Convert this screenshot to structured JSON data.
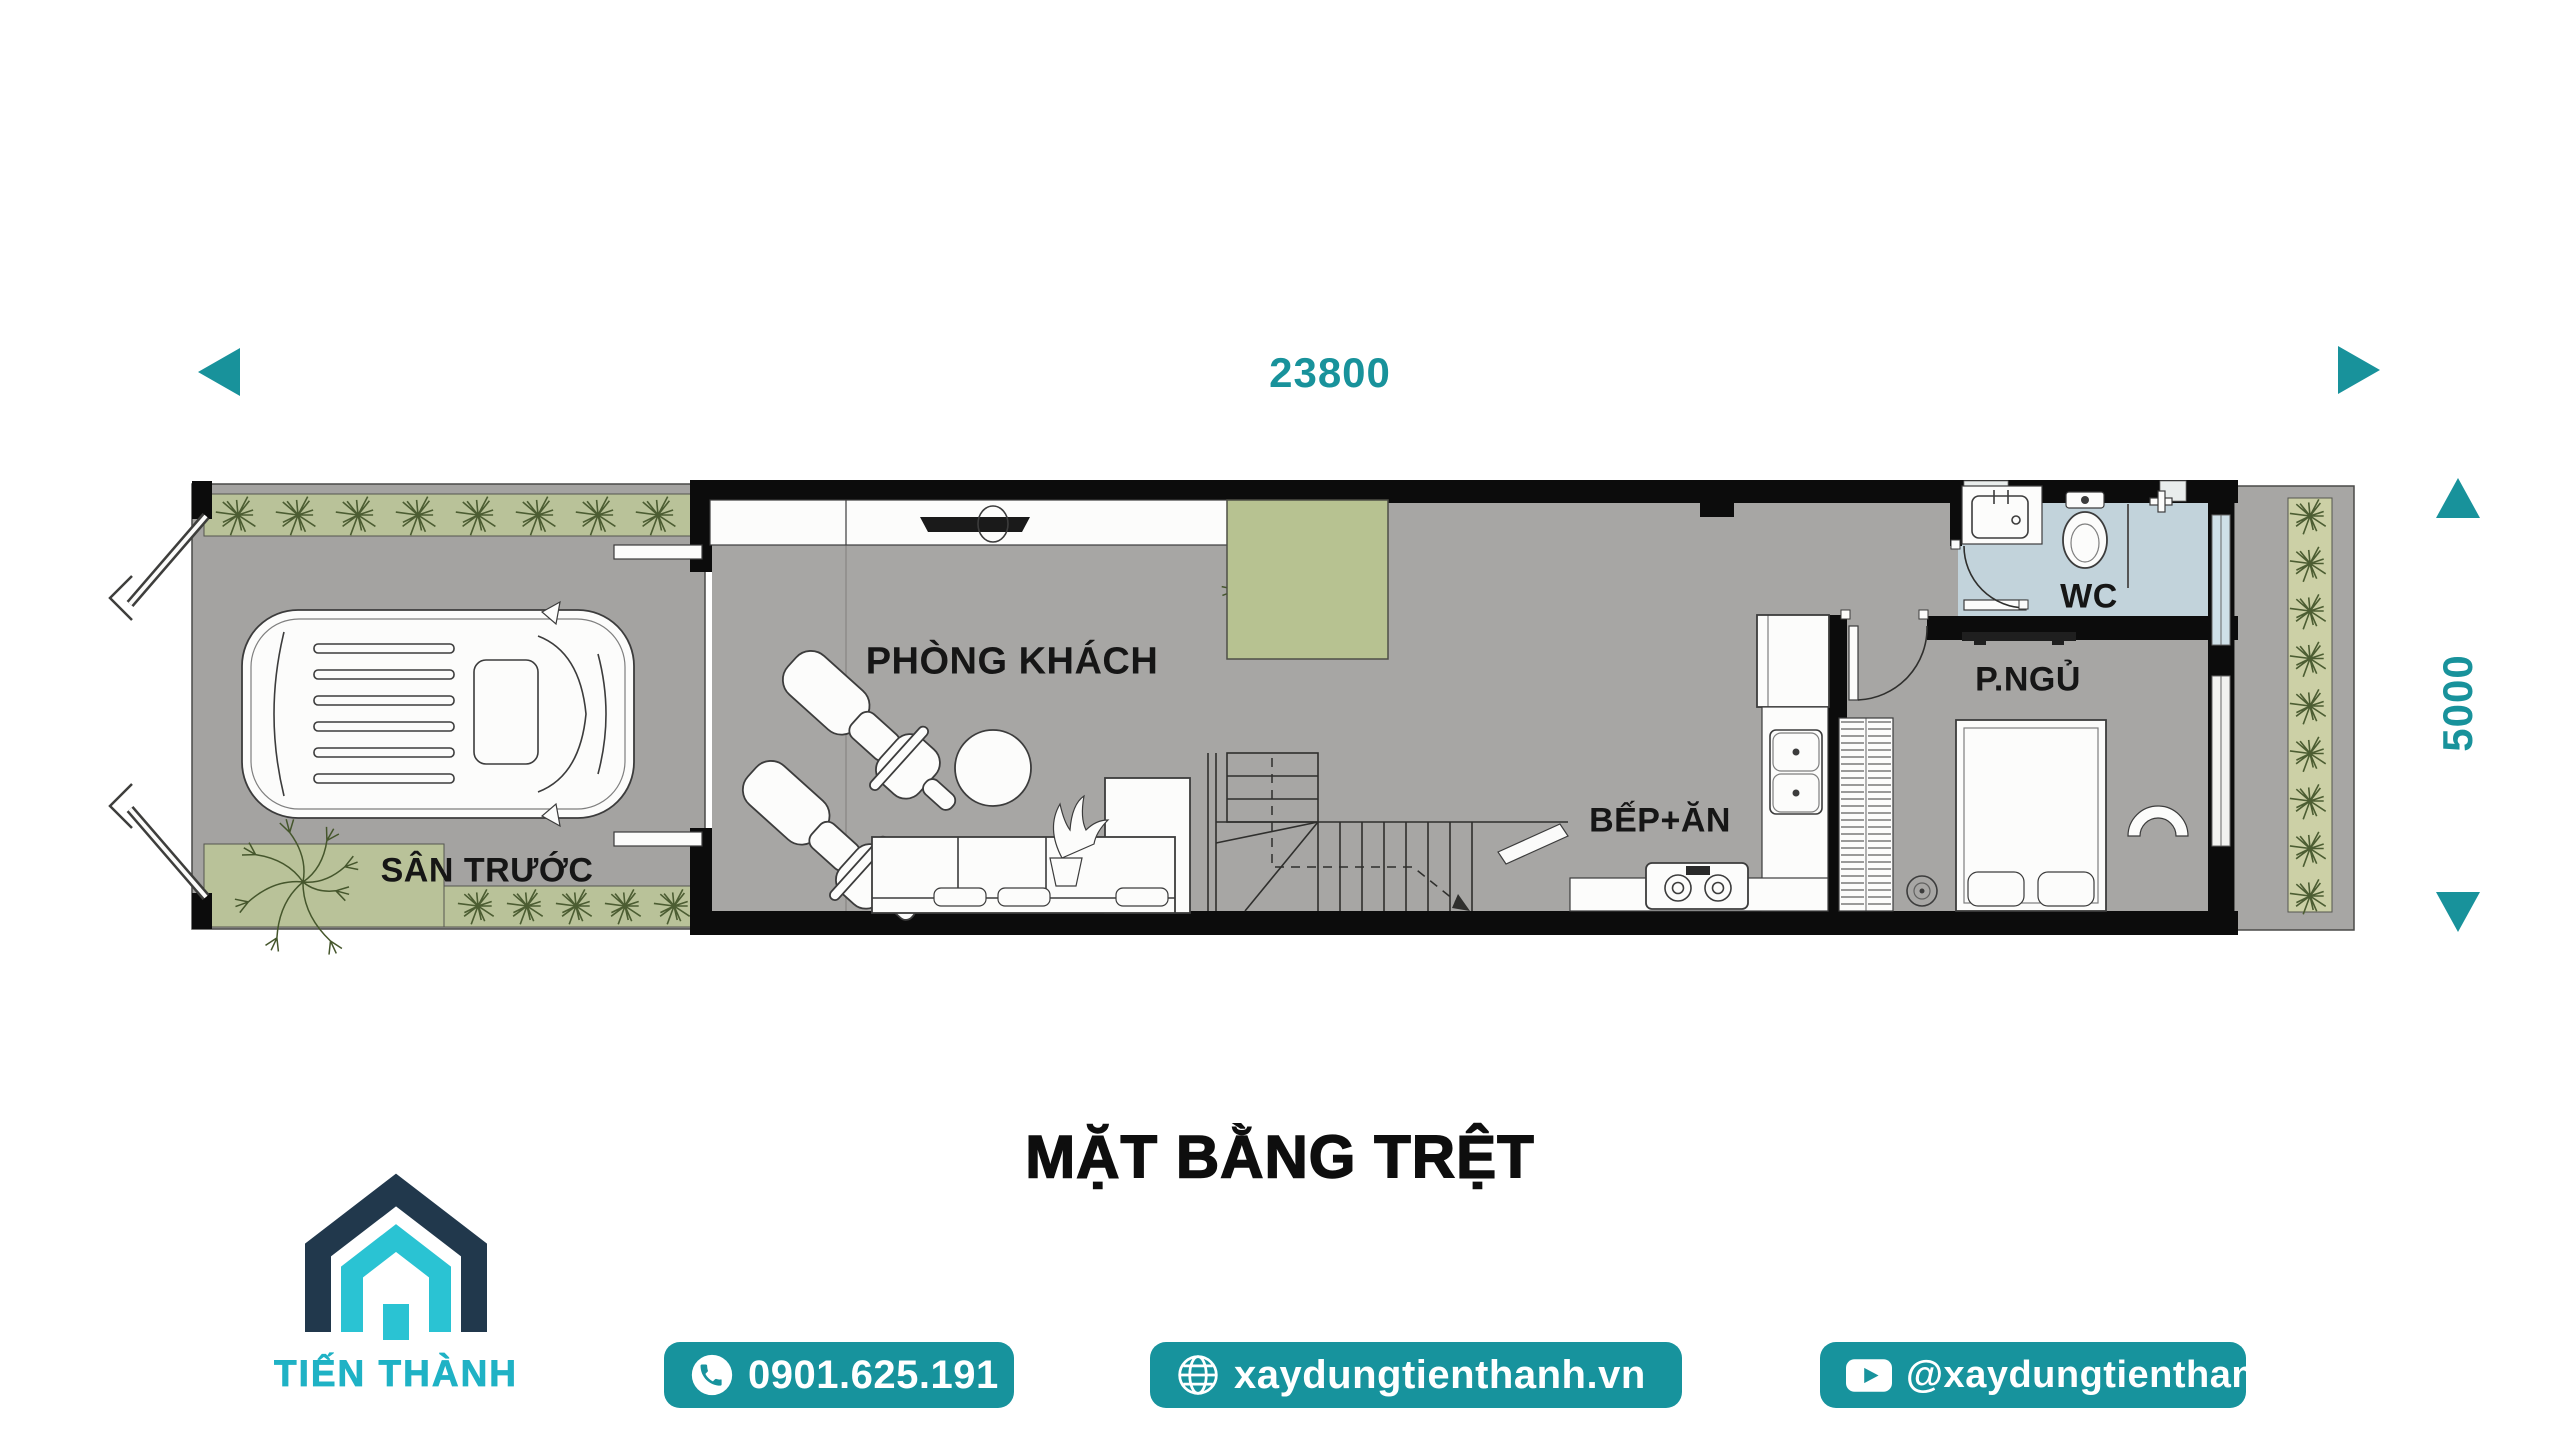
{
  "dimensions": {
    "width": {
      "label": "23800"
    },
    "depth": {
      "label": "5000"
    }
  },
  "plan": {
    "rooms": [
      {
        "id": "front-yard",
        "label": "SÂN TRƯỚC"
      },
      {
        "id": "living-room",
        "label": "PHÒNG KHÁCH"
      },
      {
        "id": "kitchen-dining",
        "label": "BẾP+ĂN"
      },
      {
        "id": "wc",
        "label": "WC"
      },
      {
        "id": "bedroom",
        "label": "P.NGỦ"
      }
    ]
  },
  "title": "MẶT BẰNG TRỆT",
  "footer": {
    "brand": "TIẾN THÀNH",
    "phone": "0901.625.191",
    "website": "xaydungtienthanh.vn",
    "youtube": "@xaydungtienthanh"
  },
  "colors": {
    "accent_teal": "#18929b",
    "logo_navy": "#21384c",
    "logo_teal": "#2ac3d3",
    "wall_black": "#0c0c0c",
    "floor_gray": "#a7a6a4",
    "planter_green": "#b9c299",
    "backyard_planter_green": "#ccd0a6",
    "wc_floor_blue": "#c2d3db"
  },
  "icons": {
    "phone": "phone-icon",
    "globe": "globe-icon",
    "youtube": "youtube-icon",
    "logo": "house-logo-icon",
    "arrows": "dimension-arrow-icons"
  }
}
